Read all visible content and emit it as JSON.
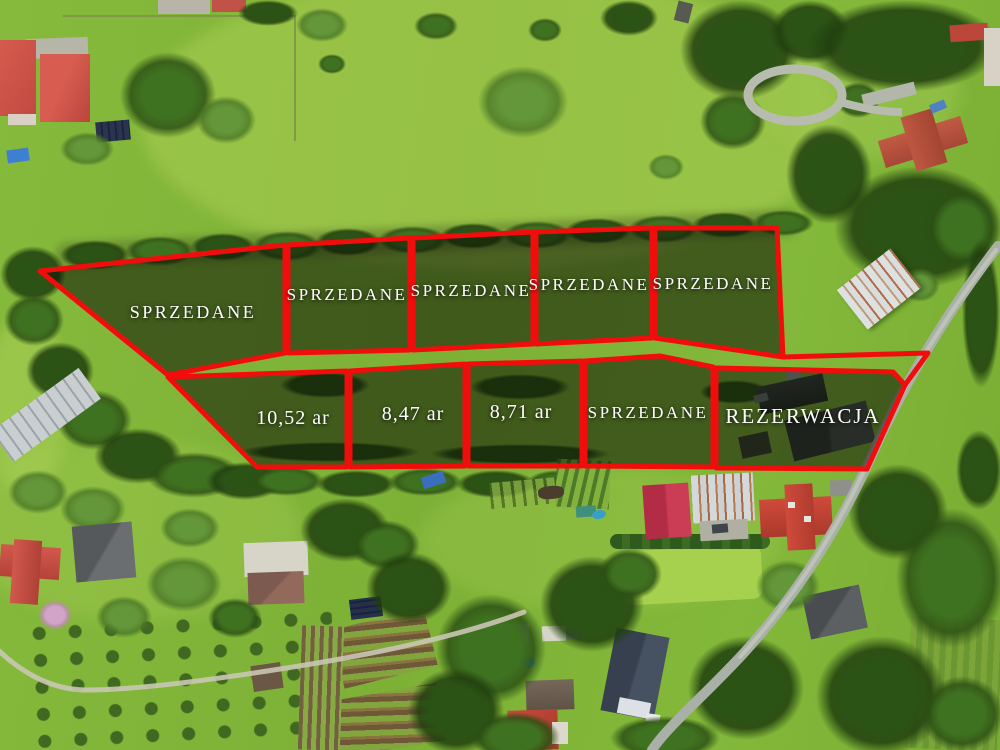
{
  "palette": {
    "overlay_red": "#f20d0d",
    "plot_fill": "rgba(12,18,6,0.55)",
    "label_color": "#ffffff",
    "grass_green": "#84b93a",
    "roof_red": "#c8473c",
    "road_gray": "#a9b0a8"
  },
  "overlay": {
    "plots": [
      {
        "label": "SPRZEDANE",
        "points": "40,271 285,245 285,353 168,375"
      },
      {
        "label": "SPRZEDANE",
        "points": "288,245 410,238 410,350 288,353"
      },
      {
        "label": "SPRZEDANE",
        "points": "413,238 533,232 533,344 413,350"
      },
      {
        "label": "SPRZEDANE",
        "points": "536,232 652,228 652,338 536,344"
      },
      {
        "label": "SPRZEDANE",
        "points": "655,228 777,228 783,357 655,338"
      },
      {
        "label": "10,52 ar",
        "points": "168,377 347,371 347,467 257,467"
      },
      {
        "label": "8,47 ar",
        "points": "350,371 465,364 465,466 350,467"
      },
      {
        "label": "8,71 ar",
        "points": "468,364 582,361 582,466 468,466"
      },
      {
        "label": "SPRZEDANE",
        "points": "585,361 660,356 713,367 713,467 585,466"
      },
      {
        "label": "REZERWACJA",
        "points": "716,368 893,372 905,385 867,469 716,468"
      }
    ],
    "boundary_extension": {
      "points": "783,357 928,353 905,385"
    }
  }
}
